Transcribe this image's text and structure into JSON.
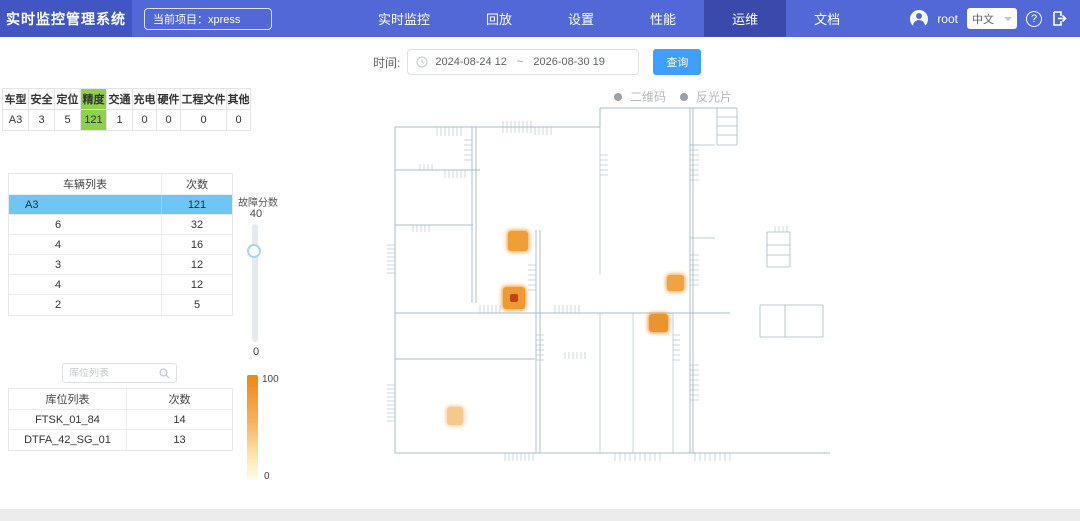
{
  "header": {
    "brand": "实时监控管理系统",
    "project_label": "当前项目：xpress",
    "nav": [
      {
        "label": "实时监控",
        "active": false
      },
      {
        "label": "回放",
        "active": false
      },
      {
        "label": "设置",
        "active": false
      },
      {
        "label": "性能",
        "active": false
      },
      {
        "label": "运维",
        "active": true
      },
      {
        "label": "文档",
        "active": false
      }
    ],
    "user": "root",
    "language": "中文",
    "help_glyph": "?"
  },
  "filter": {
    "time_label": "时间:",
    "start": "2024-08-24 12",
    "separator": "~",
    "end": "2026-08-30 19",
    "query_button": "查询"
  },
  "stats": {
    "columns": [
      "车型",
      "安全",
      "定位",
      "精度",
      "交通",
      "充电",
      "硬件",
      "工程文件",
      "其他"
    ],
    "values": [
      "A3",
      "3",
      "5",
      "121",
      "1",
      "0",
      "0",
      "0",
      "0"
    ],
    "highlight_index": 3,
    "highlight_color": "#8fd14a"
  },
  "vehicle_table": {
    "headers": [
      "车辆列表",
      "次数"
    ],
    "rows": [
      {
        "name": "A3",
        "count": "121",
        "selected": true,
        "indent": false
      },
      {
        "name": "6",
        "count": "32",
        "selected": false,
        "indent": true
      },
      {
        "name": "4",
        "count": "16",
        "selected": false,
        "indent": true
      },
      {
        "name": "3",
        "count": "12",
        "selected": false,
        "indent": true
      },
      {
        "name": "4",
        "count": "12",
        "selected": false,
        "indent": true
      },
      {
        "name": "2",
        "count": "5",
        "selected": false,
        "indent": true
      }
    ],
    "selected_color": "#6fc6f3"
  },
  "fault_slider": {
    "label": "故障分数",
    "max_label": "40",
    "min_label": "0"
  },
  "storage_search": {
    "placeholder": "库位列表"
  },
  "storage_table": {
    "headers": [
      "库位列表",
      "次数"
    ],
    "rows": [
      {
        "name": "FTSK_01_84",
        "count": "14"
      },
      {
        "name": "DTFA_42_SG_01",
        "count": "13"
      }
    ]
  },
  "heat_legend": {
    "max_label": "100",
    "min_label": "0",
    "top_color": "#ee8614",
    "bottom_color": "#fffcea"
  },
  "map": {
    "legend": [
      {
        "label": "二维码"
      },
      {
        "label": "反光片"
      }
    ],
    "markers": [
      {
        "x": 123,
        "y": 146,
        "w": 20,
        "h": 20,
        "color": "#f09f38"
      },
      {
        "x": 118,
        "y": 202,
        "w": 22,
        "h": 22,
        "color": "#ed9a33",
        "core": "#c04418"
      },
      {
        "x": 282,
        "y": 190,
        "w": 17,
        "h": 16,
        "color": "#f0a344"
      },
      {
        "x": 264,
        "y": 229,
        "w": 19,
        "h": 18,
        "color": "#e99430"
      },
      {
        "x": 62,
        "y": 322,
        "w": 16,
        "h": 18,
        "color": "#f3c98d"
      }
    ]
  }
}
